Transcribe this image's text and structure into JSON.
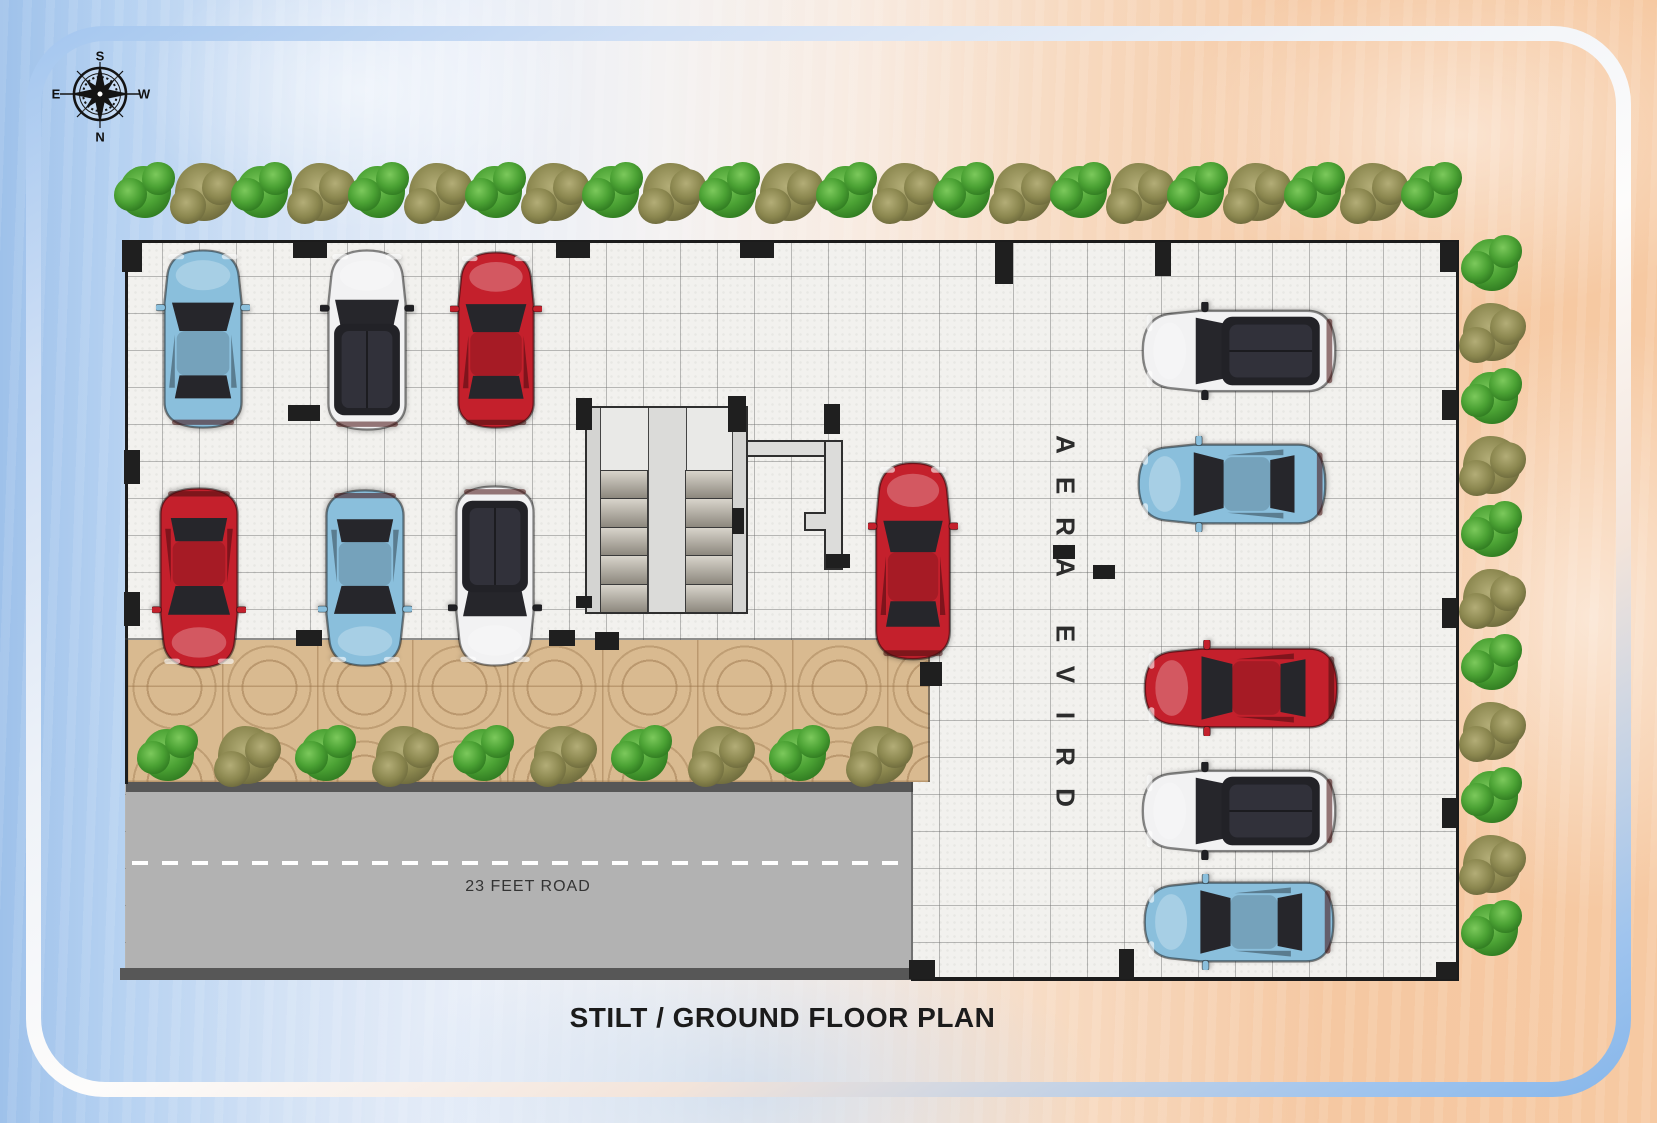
{
  "title": "STILT / GROUND FLOOR PLAN",
  "compass": {
    "top": "S",
    "right": "W",
    "bottom": "N",
    "left": "E"
  },
  "road": {
    "label": "23 FEET ROAD"
  },
  "drive_area": {
    "label": "DRIVE AREA"
  },
  "palette": {
    "car_red": "#c4202c",
    "car_blue": "#8abfdc",
    "car_white": "#f2f2f3",
    "tree_green": "#4ba234",
    "tree_olive": "#8b874f",
    "road_gray": "#b2b2b2",
    "paving_tan": "#d9ba90",
    "wall_black": "#1c1c1c"
  },
  "cars": [
    {
      "id": "car-1",
      "color": "blue",
      "type": "hatch",
      "facing": "up",
      "x": 156,
      "y": 246,
      "w": 94,
      "h": 186
    },
    {
      "id": "car-2",
      "color": "white",
      "type": "suv",
      "facing": "up",
      "x": 320,
      "y": 246,
      "w": 94,
      "h": 188
    },
    {
      "id": "car-3",
      "color": "red",
      "type": "sedan",
      "facing": "up",
      "x": 450,
      "y": 248,
      "w": 92,
      "h": 184
    },
    {
      "id": "car-4",
      "color": "red",
      "type": "sedan",
      "facing": "down",
      "x": 152,
      "y": 484,
      "w": 94,
      "h": 188
    },
    {
      "id": "car-5",
      "color": "blue",
      "type": "hatch",
      "facing": "down",
      "x": 318,
      "y": 486,
      "w": 94,
      "h": 184
    },
    {
      "id": "car-6",
      "color": "white",
      "type": "suv",
      "facing": "down",
      "x": 448,
      "y": 482,
      "w": 94,
      "h": 188
    },
    {
      "id": "car-7",
      "color": "red",
      "type": "sedan",
      "facing": "up",
      "x": 868,
      "y": 458,
      "w": 90,
      "h": 206
    },
    {
      "id": "car-8",
      "color": "white",
      "type": "suv",
      "facing": "left",
      "x": 1138,
      "y": 302,
      "w": 202,
      "h": 98
    },
    {
      "id": "car-9",
      "color": "blue",
      "type": "hatch",
      "facing": "left",
      "x": 1134,
      "y": 436,
      "w": 196,
      "h": 96
    },
    {
      "id": "car-10",
      "color": "red",
      "type": "sedan",
      "facing": "left",
      "x": 1140,
      "y": 640,
      "w": 202,
      "h": 96
    },
    {
      "id": "car-11",
      "color": "white",
      "type": "suv",
      "facing": "left",
      "x": 1138,
      "y": 762,
      "w": 202,
      "h": 98
    },
    {
      "id": "car-12",
      "color": "blue",
      "type": "hatch",
      "facing": "left",
      "x": 1140,
      "y": 874,
      "w": 198,
      "h": 96
    }
  ],
  "trees": {
    "rows": [
      {
        "id": "top-row",
        "axis": "h",
        "x": 145,
        "y": 192,
        "step": 58.5,
        "count": 23
      },
      {
        "id": "right-column",
        "axis": "v",
        "x": 1492,
        "y": 265,
        "step": 66.5,
        "count": 11
      },
      {
        "id": "walkway-row",
        "axis": "h",
        "x": 168,
        "y": 755,
        "step": 79,
        "count": 10
      }
    ]
  },
  "structure": {
    "columns": [
      [
        122,
        240,
        20,
        32
      ],
      [
        293,
        242,
        34,
        16
      ],
      [
        556,
        242,
        34,
        16
      ],
      [
        740,
        242,
        34,
        16
      ],
      [
        995,
        242,
        18,
        42
      ],
      [
        1155,
        242,
        16,
        34
      ],
      [
        1440,
        242,
        17,
        30
      ],
      [
        124,
        450,
        16,
        34
      ],
      [
        124,
        592,
        16,
        34
      ],
      [
        1442,
        390,
        15,
        30
      ],
      [
        1442,
        598,
        15,
        30
      ],
      [
        1442,
        798,
        15,
        30
      ],
      [
        1436,
        962,
        21,
        17
      ],
      [
        909,
        960,
        26,
        19
      ],
      [
        1119,
        949,
        15,
        30
      ],
      [
        288,
        405,
        32,
        16
      ],
      [
        296,
        630,
        26,
        16
      ],
      [
        549,
        630,
        26,
        16
      ],
      [
        595,
        632,
        24,
        18
      ],
      [
        920,
        662,
        22,
        24
      ],
      [
        1053,
        545,
        22,
        14
      ],
      [
        1093,
        565,
        22,
        14
      ],
      [
        576,
        398,
        16,
        32
      ],
      [
        728,
        396,
        18,
        36
      ],
      [
        824,
        404,
        16,
        30
      ],
      [
        826,
        554,
        24,
        14
      ],
      [
        732,
        508,
        12,
        26
      ],
      [
        576,
        596,
        16,
        12
      ]
    ]
  }
}
